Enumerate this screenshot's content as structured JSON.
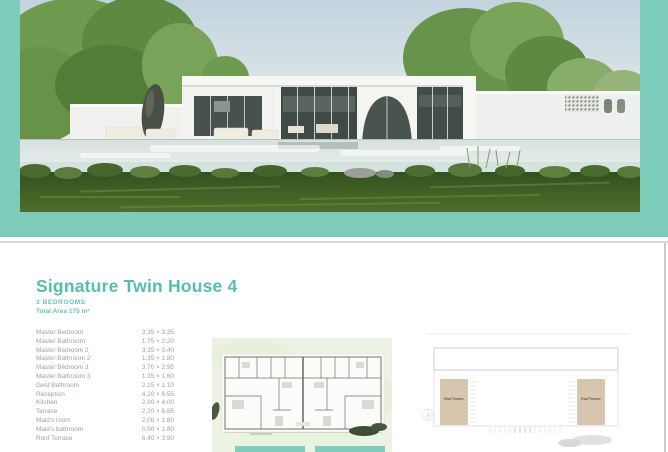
{
  "theme": {
    "accent_teal": "#7ecdbb",
    "title_teal": "#54bfab",
    "text_gray": "#9ba2a5",
    "plan_tan": "#d9c7b1",
    "pool_teal": "#82ccbd"
  },
  "listing": {
    "title": "Signature Twin House 4",
    "bedrooms": "3 BEDROOMS",
    "total_area": "Total Area 175 m²",
    "rooms": [
      {
        "label": "Master Bedroom",
        "dims": "3.35 × 3.35"
      },
      {
        "label": "Master Bathroom",
        "dims": "1.75 × 2.20"
      },
      {
        "label": "Master Bedroom 2",
        "dims": "3.35 × 3.40"
      },
      {
        "label": "Master Bathroom 2",
        "dims": "1.35 × 1.80"
      },
      {
        "label": "Master Bedroom 3",
        "dims": "3.70 × 2.95"
      },
      {
        "label": "Master Bathroom 3",
        "dims": "1.35 × 1.60"
      },
      {
        "label": "Gest Bathroom",
        "dims": "2.15 × 1.10"
      },
      {
        "label": "Reception",
        "dims": "4.20 × 6.55"
      },
      {
        "label": "Kitchen",
        "dims": "2.90 × 4.00"
      },
      {
        "label": "Terrace",
        "dims": "2.20 × 6.85"
      },
      {
        "label": "Maid's room",
        "dims": "2.00 × 1.80"
      },
      {
        "label": "Maid's bathroom",
        "dims": "0.90 × 1.80"
      },
      {
        "label": "Roof Terrace",
        "dims": "6.40 × 3.90"
      }
    ]
  },
  "plans": {
    "roof_terrace_label": "Roof Terrace"
  }
}
